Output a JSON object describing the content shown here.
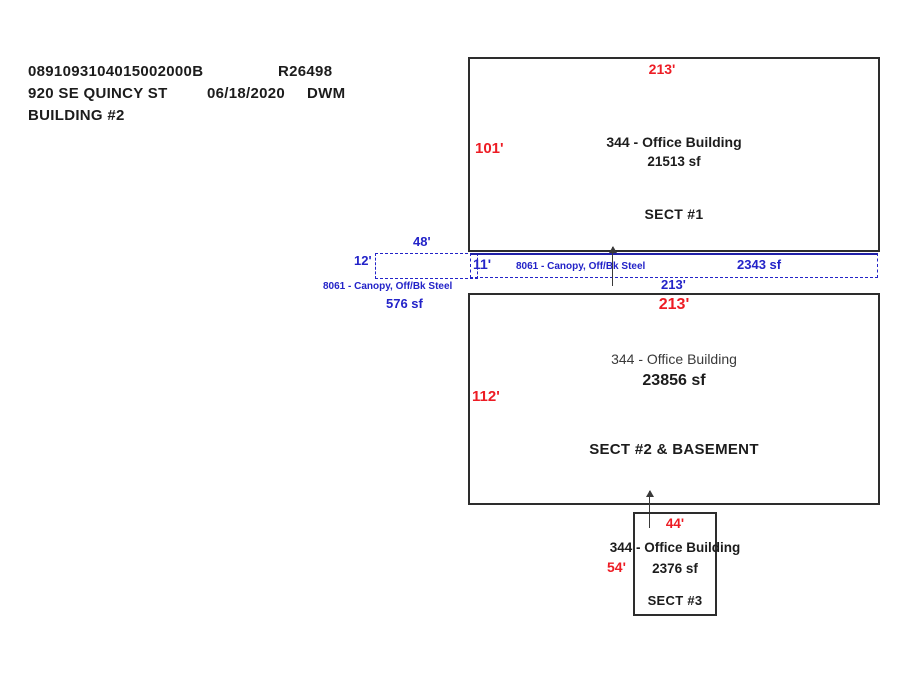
{
  "colors": {
    "dim_red": "#ed1c24",
    "canopy_blue": "#2323c8",
    "canopy_dark": "#2020a8",
    "line_black": "#2d2d2d",
    "text_black": "#1c1c1c",
    "muted_black": "#3a3a3a"
  },
  "header": {
    "parcel_id": "0891093104015002000B",
    "roll_id": "R26498",
    "address": "920 SE QUINCY ST",
    "date": "06/18/2020",
    "appraiser": "DWM",
    "building_label": "BUILDING #2"
  },
  "sect1": {
    "top_dim": "213'",
    "left_dim": "101'",
    "use_label": "344 - Office Building",
    "area": "21513 sf",
    "name": "SECT #1"
  },
  "canopy_strip": {
    "height_dim": "11'",
    "label": "8061 - Canopy, Off/Bk Steel",
    "area": "2343 sf",
    "bottom_dim": "213'"
  },
  "canopy_small": {
    "top_dim": "48'",
    "left_dim": "12'",
    "label": "8061 - Canopy, Off/Bk Steel",
    "area": "576 sf"
  },
  "sect2": {
    "top_dim": "213'",
    "left_dim": "112'",
    "use_label": "344 - Office Building",
    "area": "23856 sf",
    "name": "SECT #2 & BASEMENT"
  },
  "sect3": {
    "top_dim": "44'",
    "left_dim": "54'",
    "use_label": "344 - Office Building",
    "area": "2376 sf",
    "name": "SECT #3"
  }
}
